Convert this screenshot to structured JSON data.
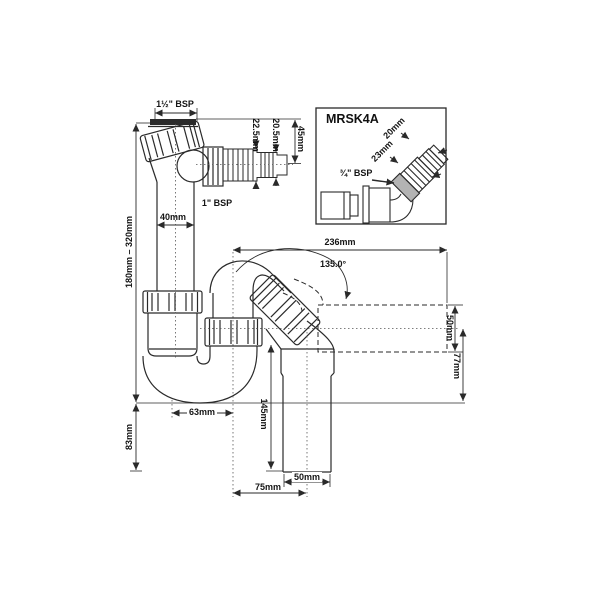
{
  "diagram": {
    "kind": "plumbing-trap-technical-drawing",
    "product_code": "MRSK4A",
    "background": "#ffffff",
    "line_color": "#2a2a2a",
    "washer_color": "#2b2b2b",
    "thread_band_color": "#b3b3b3"
  },
  "main_view": {
    "labels": {
      "inlet_thread": "1½\" BSP",
      "branch_thread": "1\" BSP",
      "tail_step_large": "22.5mm",
      "tail_step_small": "20.5mm",
      "tail_length": "45mm",
      "pipe_diameter": "40mm",
      "adjustable_height": "180mm – 320mm",
      "seal_depth": "83mm",
      "trap_offset": "63mm",
      "overall_reach": "236mm",
      "outlet_angle": "135.0°",
      "outlet_dia_side": "50mm",
      "outlet_drop": "77mm",
      "outlet_length": "145mm",
      "outlet_dia_bottom": "50mm",
      "outlet_offset": "75mm"
    }
  },
  "inset_view": {
    "title": "MRSK4A",
    "labels": {
      "hose_tip": "20mm",
      "hose_mid": "23mm",
      "thread": "¾\" BSP"
    }
  }
}
